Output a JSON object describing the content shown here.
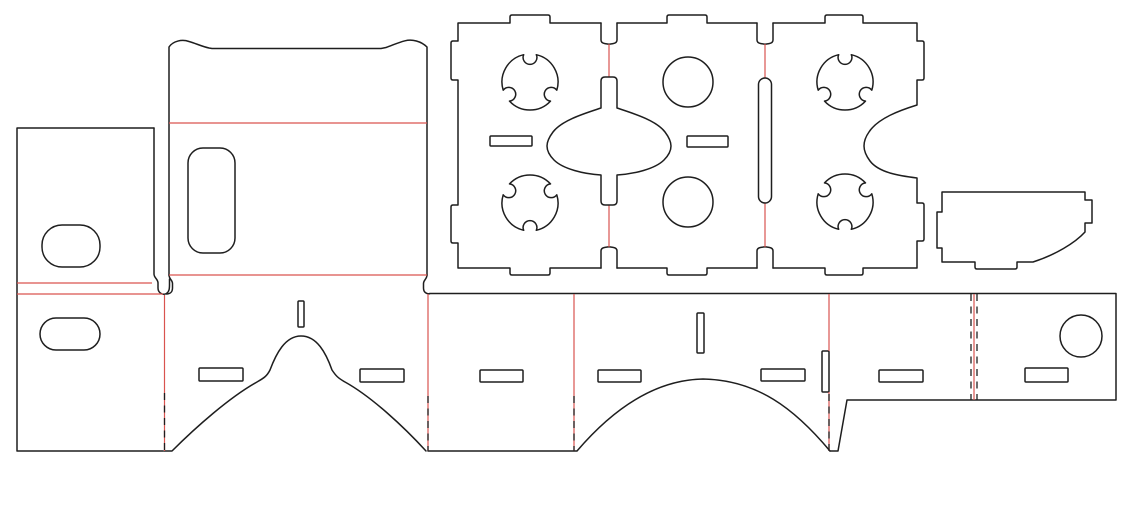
{
  "canvas": {
    "width": 1132,
    "height": 505,
    "background": "#ffffff"
  },
  "colors": {
    "cut": "#1e1e1e",
    "fold": "#d9534f"
  },
  "notch": {
    "half_angle_deg": 13,
    "depth_factor": 1.1
  },
  "pieces": [
    {
      "name": "side-flap-left",
      "shapes": [
        {
          "t": "path",
          "k": "cut",
          "d": "M154,128 H17 V451 H163"
        },
        {
          "t": "path",
          "k": "cut",
          "d": "M154,128 V274 C154,278 158,279 158,283 L158,288 C158,293 163,295.5 166.5,293.5 C169.5,291.5 169.5,288 169.5,284 L169.5,279"
        },
        {
          "t": "stadium",
          "k": "cut",
          "x": 42,
          "y": 225,
          "w": 58,
          "h": 42,
          "r": 20
        },
        {
          "t": "stadium",
          "k": "cut",
          "x": 40,
          "y": 318,
          "w": 60,
          "h": 32,
          "r": 16
        },
        {
          "t": "line",
          "k": "fold",
          "x1": 17,
          "y1": 283,
          "x2": 152,
          "y2": 283
        },
        {
          "t": "line",
          "k": "fold",
          "x1": 17,
          "y1": 294,
          "x2": 163,
          "y2": 294
        }
      ]
    },
    {
      "name": "top-flap",
      "shapes": [
        {
          "t": "path",
          "k": "cut",
          "d": "M169,275 L169,47 C173,41 182,39 189,41.5 C196,43.5 202,46.5 209,48 L212,48.5 L381,48.5 L386,47.5 C392,45.5 398,42.5 405,40.8 C412,39 421,41 427,47 L427,275"
        },
        {
          "t": "path",
          "k": "cut",
          "d": "M169,275 C169,279 172.5,280 172.5,283.5 L172.5,288 C172.5,292 170,294 166.5,294"
        },
        {
          "t": "path",
          "k": "cut",
          "d": "M427,275 C427,279 423.5,280 423.5,283.5 L423.5,288 C423.5,292 426,294 429.5,293.8"
        },
        {
          "t": "stadium",
          "k": "cut",
          "x": 188,
          "y": 148,
          "w": 47,
          "h": 105,
          "r": 15
        },
        {
          "t": "line",
          "k": "fold",
          "x1": 169,
          "y1": 123,
          "x2": 427,
          "y2": 123
        },
        {
          "t": "line",
          "k": "fold",
          "x1": 169,
          "y1": 275,
          "x2": 427,
          "y2": 275
        }
      ]
    },
    {
      "name": "lens-plate-left",
      "shapes": [
        {
          "t": "path",
          "k": "cut",
          "d": "M601,23 L550,23 L550,17 Q550,15 548,15 L512,15 Q510,15 510,17 L510,23 L458,23 L458,41 L453,41 Q451,41 451,43 L451,78 Q451,80 453,80 L458,80 L458,205 L453,205 Q451,205 451,207 L451,241 Q451,243 453,243 L458,243 L458,268 L510,268 L510,273 Q510,275 512,275 L548,275 Q550,275 550,273 L550,268 L601,268"
        },
        {
          "t": "rect",
          "k": "cut",
          "x": 490,
          "y": 136,
          "w": 42,
          "h": 10,
          "r": 1
        },
        {
          "t": "notched",
          "k": "cut",
          "cx": 530,
          "cy": 82,
          "r": 28,
          "angles": [
            270,
            30,
            150
          ]
        },
        {
          "t": "notched",
          "k": "cut",
          "cx": 530,
          "cy": 203,
          "r": 28,
          "angles": [
            90,
            210,
            330
          ]
        }
      ]
    },
    {
      "name": "panel-hinge-left",
      "shapes": [
        {
          "t": "path",
          "k": "cut",
          "d": "M601,23 L601,40 Q601,43 605,43.6 L609,44.2 L613,43.6 Q617,43 617,40 L617,23"
        },
        {
          "t": "path",
          "k": "cut",
          "d": "M601,268 L601,251 Q601,248 605,247.4 L609,246.8 L613,247.4 Q617,248 617,251 L617,268"
        },
        {
          "t": "line",
          "k": "fold",
          "x1": 609,
          "y1": 44,
          "x2": 609,
          "y2": 77
        },
        {
          "t": "line",
          "k": "fold",
          "x1": 609,
          "y1": 205,
          "x2": 609,
          "y2": 247
        },
        {
          "t": "path",
          "k": "cut",
          "d": "M605,77 L613,77 Q617,77 617,81 L617,108 C632,113 656,120 665,132 Q671,140 671,146 Q671,153 664,160 C655,169 634,174 617,175 L617,201 Q617,205 613,205 L605,205 Q601,205 601,201 L601,175 C584,174 563,169 554,160 Q547,153 547,146 Q547,140 553,132 C562,120 586,113 601,108 L601,81 Q601,77 605,77 Z"
        }
      ]
    },
    {
      "name": "lens-plate-center",
      "shapes": [
        {
          "t": "path",
          "k": "cut",
          "d": "M617,23 L667,23 L667,17 Q667,15 669,15 L705,15 Q707,15 707,17 L707,23 L757,23"
        },
        {
          "t": "path",
          "k": "cut",
          "d": "M617,268 L667,268 L667,273 Q667,275 669,275 L705,275 Q707,275 707,273 L707,268 L757,268"
        },
        {
          "t": "circle",
          "k": "cut",
          "cx": 688,
          "cy": 82,
          "r": 25
        },
        {
          "t": "circle",
          "k": "cut",
          "cx": 688,
          "cy": 202,
          "r": 25
        },
        {
          "t": "rect",
          "k": "cut",
          "x": 687,
          "y": 136,
          "w": 41,
          "h": 11,
          "r": 1
        }
      ]
    },
    {
      "name": "panel-hinge-right",
      "shapes": [
        {
          "t": "path",
          "k": "cut",
          "d": "M757,23 L757,40 Q757,43 761,43.6 L765,44.2 L769,43.6 Q773,43 773,40 L773,23"
        },
        {
          "t": "path",
          "k": "cut",
          "d": "M757,268 L757,251 Q757,248 761,247.4 L765,246.8 L769,247.4 Q773,248 773,251 L773,268"
        },
        {
          "t": "line",
          "k": "fold",
          "x1": 765,
          "y1": 44,
          "x2": 765,
          "y2": 78
        },
        {
          "t": "line",
          "k": "fold",
          "x1": 765,
          "y1": 203,
          "x2": 765,
          "y2": 247
        },
        {
          "t": "stadium",
          "k": "cut",
          "x": 758.5,
          "y": 78,
          "w": 13,
          "h": 125,
          "r": 6.5
        }
      ]
    },
    {
      "name": "lens-plate-right",
      "shapes": [
        {
          "t": "path",
          "k": "cut",
          "d": "M773,23 L825,23 L825,17 Q825,15 827,15 L861,15 Q863,15 863,17 L863,23 L917,23 L917,41 L922,41 Q924,41 924,43 L924,78 Q924,80 922,80 L917,80 L917,105 C901,110 878,118 869,132 Q864,139 864,146 Q864,153 870,161 C879,173 901,176 917,178 L917,203 L922,203 Q924,203 924,205 L924,239 Q924,241 922,241 L917,241 L917,268 L863,268 L863,273 Q863,275 861,275 L827,275 Q825,275 825,273 L825,268 L773,268"
        },
        {
          "t": "notched",
          "k": "cut",
          "cx": 845,
          "cy": 82,
          "r": 28,
          "angles": [
            270,
            30,
            150
          ]
        },
        {
          "t": "notched",
          "k": "cut",
          "cx": 845,
          "cy": 202,
          "r": 28,
          "angles": [
            90,
            210,
            330
          ]
        }
      ]
    },
    {
      "name": "side-tab",
      "shapes": [
        {
          "t": "path",
          "k": "cut",
          "d": "M942,192 L1085,192 L1085,200 L1092,200 L1092,223 L1085,223 L1085,232 C1075,243 1055,255 1033,262 L1017,262 L1017,267 Q1017,269 1015,269 L977,269 Q975,269 975,267 L975,262 L942,262 L942,248 L937,248 L937,212 L942,212 Z"
        }
      ]
    },
    {
      "name": "body-strip",
      "shapes": [
        {
          "t": "path",
          "k": "cut",
          "d": "M429.5,293.5 L1116,293.5 L1116,400 L847,400 L838,451 L830,451"
        },
        {
          "t": "path",
          "k": "cut",
          "d": "M830,451 C794,408 757,380 703,379 C649,380 607,416 577,451 L428,451"
        },
        {
          "t": "path",
          "k": "cut",
          "d": "M426,451 C404,427 372,397 345,382 C338,378 336,376 332,370 C326,353 317,336 301,336 C285,336 276,354 270,370 C267,376 264,378 257,382 C230,397 196,427 172,451 L164,451"
        },
        {
          "t": "rect",
          "k": "cut",
          "x": 199,
          "y": 368,
          "w": 44,
          "h": 13,
          "r": 1
        },
        {
          "t": "rect",
          "k": "cut",
          "x": 360,
          "y": 369,
          "w": 44,
          "h": 13,
          "r": 1
        },
        {
          "t": "rect",
          "k": "cut",
          "x": 480,
          "y": 370,
          "w": 43,
          "h": 12,
          "r": 1
        },
        {
          "t": "rect",
          "k": "cut",
          "x": 598,
          "y": 370,
          "w": 43,
          "h": 12,
          "r": 1
        },
        {
          "t": "rect",
          "k": "cut",
          "x": 761,
          "y": 369,
          "w": 44,
          "h": 12,
          "r": 1
        },
        {
          "t": "rect",
          "k": "cut",
          "x": 879,
          "y": 370,
          "w": 44,
          "h": 12,
          "r": 1
        },
        {
          "t": "rect",
          "k": "cut",
          "x": 1025,
          "y": 368,
          "w": 43,
          "h": 14,
          "r": 1
        },
        {
          "t": "rect",
          "k": "cut",
          "x": 298,
          "y": 301,
          "w": 6,
          "h": 26,
          "r": 1
        },
        {
          "t": "rect",
          "k": "cut",
          "x": 697,
          "y": 313,
          "w": 7,
          "h": 40,
          "r": 1
        },
        {
          "t": "rect",
          "k": "cut",
          "x": 822,
          "y": 351,
          "w": 7,
          "h": 41,
          "r": 1
        },
        {
          "t": "circle",
          "k": "cut",
          "cx": 1081,
          "cy": 336,
          "r": 21
        },
        {
          "t": "line",
          "k": "fold",
          "x1": 164.5,
          "y1": 295,
          "x2": 164.5,
          "y2": 451
        },
        {
          "t": "line",
          "k": "fold",
          "x1": 428,
          "y1": 294,
          "x2": 428,
          "y2": 451
        },
        {
          "t": "line",
          "k": "fold",
          "x1": 574,
          "y1": 294,
          "x2": 574,
          "y2": 451
        },
        {
          "t": "line",
          "k": "fold",
          "x1": 829,
          "y1": 294,
          "x2": 829,
          "y2": 351
        },
        {
          "t": "line",
          "k": "fold",
          "x1": 829,
          "y1": 392,
          "x2": 829,
          "y2": 451
        },
        {
          "t": "line",
          "k": "fold",
          "x1": 974,
          "y1": 294,
          "x2": 974,
          "y2": 400
        },
        {
          "t": "line",
          "k": "dash",
          "x1": 164.5,
          "y1": 393,
          "x2": 164.5,
          "y2": 451
        },
        {
          "t": "line",
          "k": "dash",
          "x1": 428,
          "y1": 396,
          "x2": 428,
          "y2": 451
        },
        {
          "t": "line",
          "k": "dash",
          "x1": 574,
          "y1": 396,
          "x2": 574,
          "y2": 451
        },
        {
          "t": "line",
          "k": "dash",
          "x1": 829,
          "y1": 394,
          "x2": 829,
          "y2": 451
        },
        {
          "t": "line",
          "k": "dash",
          "x1": 971,
          "y1": 294,
          "x2": 971,
          "y2": 400
        },
        {
          "t": "line",
          "k": "dash",
          "x1": 977,
          "y1": 294,
          "x2": 977,
          "y2": 400
        }
      ]
    }
  ]
}
